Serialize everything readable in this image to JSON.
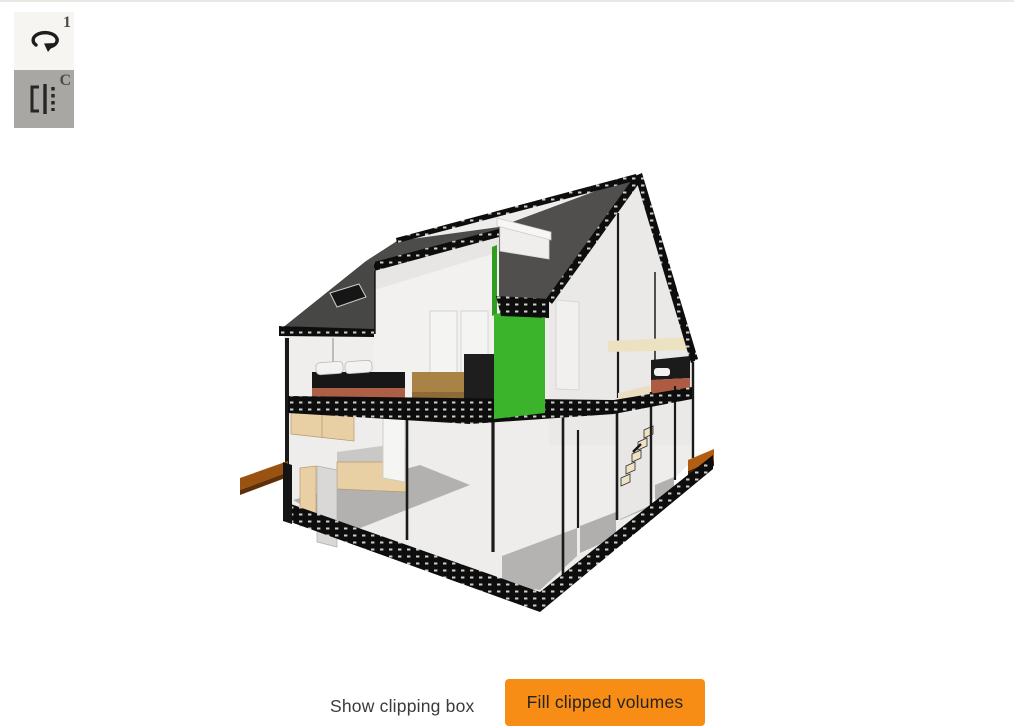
{
  "window": {
    "top_border_color": "#eae8e4",
    "background": "#ffffff"
  },
  "toolbar": {
    "view_button": {
      "label": "1"
    },
    "clip_button": {
      "label": "C"
    }
  },
  "footer": {
    "show_clipping_box": "Show clipping box",
    "fill_clipped_volumes": "Fill clipped volumes",
    "accent_color": "#f88d15"
  },
  "scene": {
    "type": "3d-house-cutaway-section",
    "roof_color": "#4e4e4c",
    "highlight_wall_color": "#3bb32b",
    "deck_color": "#9a5210",
    "bed_color": "#ad5f46",
    "kitchen_cabinet_color": "#e9cfa4"
  }
}
